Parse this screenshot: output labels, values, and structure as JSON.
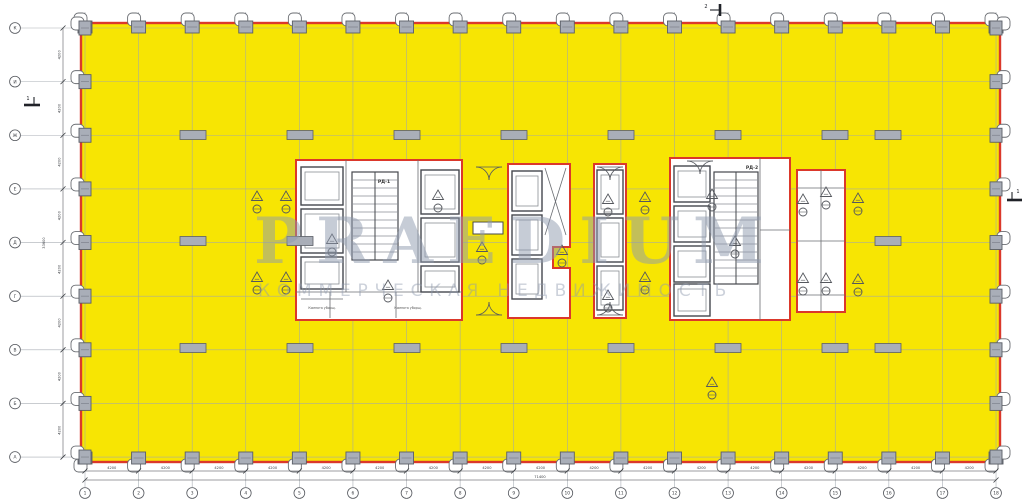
{
  "drawing": {
    "type": "architectural-floor-plan",
    "highlight_note": "open floor area highlighted yellow with red contour"
  },
  "colors": {
    "paper": "#ffffff",
    "highlight_yellow": "#F7E503",
    "contour_red": "#DB382B",
    "grid_gray": "#9FA6AD",
    "column_fill": "#A9AEB8",
    "column_stroke": "#5A5E66",
    "wall_dark": "#45484E",
    "wall_light": "#8A8E94",
    "dim_text": "#3A3D42",
    "watermark": "#8F9AAF"
  },
  "axes": {
    "columns": [
      "1",
      "2",
      "3",
      "4",
      "5",
      "6",
      "7",
      "8",
      "9",
      "10",
      "11",
      "12",
      "13",
      "14",
      "15",
      "16",
      "17",
      "18"
    ],
    "rows": [
      "К",
      "И",
      "Ж",
      "Е",
      "Д",
      "Г",
      "В",
      "Б",
      "А"
    ],
    "bay_dim": "4200",
    "total_width": "71400",
    "total_height": "33600"
  },
  "section_markers": [
    {
      "label": "1",
      "side": "left"
    },
    {
      "label": "1",
      "side": "right"
    },
    {
      "label": "2",
      "side": "top"
    }
  ],
  "core_labels": {
    "core1": "РД-1",
    "core4": "РД-2",
    "cleaner_room": "Комната уборщ."
  },
  "watermark": {
    "line1": "PRAEDIUM",
    "line2": "КОММЕРЧЕСКАЯ НЕДВИЖИМОСТЬ"
  },
  "layout": {
    "plate": {
      "x": 81,
      "y": 23,
      "w": 919,
      "h": 439
    },
    "axis_x0": 85,
    "axis_dx": 53.59,
    "axis_y0": 28,
    "axis_dy": 53.63,
    "bubble_bottom_y": 493,
    "bubble_left_x": 15,
    "bubble_r": 5.4,
    "dim_line1_y": 471,
    "dim_line2_y": 480,
    "dim_col1_x": 63,
    "dim_col2_x": 45,
    "interior_columns": [
      [
        193,
        135
      ],
      [
        300,
        135
      ],
      [
        407,
        135
      ],
      [
        514,
        135
      ],
      [
        621,
        135
      ],
      [
        728,
        135
      ],
      [
        835,
        135
      ],
      [
        888,
        135
      ],
      [
        193,
        241
      ],
      [
        300,
        241
      ],
      [
        888,
        241
      ],
      [
        193,
        348
      ],
      [
        300,
        348
      ],
      [
        407,
        348
      ],
      [
        514,
        348
      ],
      [
        621,
        348
      ],
      [
        728,
        348
      ],
      [
        835,
        348
      ],
      [
        888,
        348
      ]
    ],
    "cores": [
      {
        "x": 296,
        "y": 160,
        "w": 166,
        "h": 160,
        "label": "core1",
        "label_xy": [
          384,
          183
        ],
        "shafts": [
          [
            301,
            167,
            42,
            38
          ],
          [
            301,
            209,
            42,
            44
          ],
          [
            301,
            257,
            42,
            32
          ],
          [
            421,
            170,
            38,
            44
          ],
          [
            421,
            218,
            38,
            44
          ],
          [
            421,
            266,
            38,
            26
          ]
        ],
        "stair": [
          352,
          172,
          46,
          88,
          11
        ],
        "lines": [
          [
            296,
            292,
            462,
            292
          ],
          [
            330,
            292,
            330,
            318
          ],
          [
            396,
            292,
            396,
            318
          ],
          [
            346,
            160,
            346,
            292
          ],
          [
            418,
            160,
            418,
            292
          ],
          [
            301,
            299,
            343,
            299
          ]
        ],
        "rooms": [
          {
            "key": "cleaner_room",
            "x": 322,
            "y": 309
          },
          {
            "key": "cleaner_room",
            "x": 408,
            "y": 309
          }
        ]
      },
      {
        "path": "M508 164 H570 V247 H553 V268 H570 V318 H508 Z",
        "shafts": [
          [
            512,
            171,
            30,
            40
          ],
          [
            512,
            215,
            30,
            40
          ],
          [
            512,
            259,
            30,
            40
          ]
        ],
        "lines": [
          [
            545,
            168,
            566,
            235
          ],
          [
            545,
            235,
            566,
            168
          ]
        ]
      },
      {
        "x": 594,
        "y": 164,
        "w": 32,
        "h": 154,
        "shafts": [
          [
            597,
            170,
            26,
            44
          ],
          [
            597,
            218,
            26,
            44
          ],
          [
            597,
            266,
            26,
            44
          ]
        ]
      },
      {
        "x": 670,
        "y": 158,
        "w": 120,
        "h": 162,
        "label": "core4",
        "label_xy": [
          752,
          169
        ],
        "shafts": [
          [
            674,
            166,
            36,
            36
          ],
          [
            674,
            206,
            36,
            36
          ],
          [
            674,
            246,
            36,
            36
          ],
          [
            674,
            284,
            36,
            32
          ]
        ],
        "stair": [
          714,
          172,
          44,
          112,
          14
        ],
        "lines": [
          [
            760,
            158,
            760,
            320
          ],
          [
            760,
            230,
            790,
            230
          ]
        ]
      },
      {
        "x": 797,
        "y": 170,
        "w": 48,
        "h": 142,
        "lines": [
          [
            797,
            188,
            845,
            188
          ],
          [
            797,
            241,
            845,
            241
          ],
          [
            797,
            295,
            845,
            295
          ],
          [
            821,
            170,
            821,
            312
          ]
        ]
      }
    ],
    "extra_shafts": [
      [
        473,
        222,
        30,
        12
      ]
    ],
    "doors": [
      {
        "x": 489,
        "y": 167,
        "dir": 1
      },
      {
        "x": 489,
        "y": 315,
        "dir": -1
      },
      {
        "x": 610,
        "y": 167,
        "dir": 1
      },
      {
        "x": 610,
        "y": 315,
        "dir": -1
      },
      {
        "x": 700,
        "y": 161,
        "dir": 1
      }
    ],
    "markers": [
      [
        257,
        197
      ],
      [
        286,
        197
      ],
      [
        257,
        278
      ],
      [
        286,
        278
      ],
      [
        332,
        240
      ],
      [
        388,
        286
      ],
      [
        438,
        196
      ],
      [
        482,
        248
      ],
      [
        562,
        251
      ],
      [
        608,
        200
      ],
      [
        608,
        296
      ],
      [
        645,
        198
      ],
      [
        645,
        278
      ],
      [
        712,
        195
      ],
      [
        735,
        242
      ],
      [
        803,
        200
      ],
      [
        826,
        193
      ],
      [
        803,
        279
      ],
      [
        826,
        279
      ],
      [
        858,
        199
      ],
      [
        858,
        280
      ],
      [
        712,
        383
      ]
    ],
    "watermark_line1_xy": [
      254,
      263
    ],
    "watermark_line2_xy": [
      258,
      296
    ]
  }
}
